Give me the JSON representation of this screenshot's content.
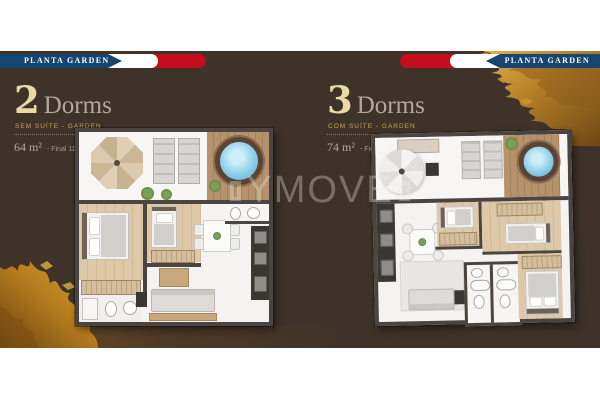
{
  "banners": {
    "left_label": "PLANTA GARDEN",
    "right_label": "PLANTA GARDEN"
  },
  "plans": [
    {
      "number": "2",
      "title": "Dorms",
      "subtitle": "SEM SUÍTE - GARDEN",
      "area": "64 m²",
      "final": "-  Final 11"
    },
    {
      "number": "3",
      "title": "Dorms",
      "subtitle": "COM SUÍTE - GARDEN",
      "area": "74 m²",
      "final": "-  Final 15"
    }
  ],
  "watermark": {
    "text": "YMOVE"
  },
  "colors": {
    "panel": "#3e3229",
    "banner_blue": "#16456f",
    "banner_red": "#c30d1e",
    "title_gold": "#ead9a2",
    "muted_gray": "#b3a89f",
    "subtitle_gold": "#c9a256",
    "wall": "#4a4541",
    "jacuzzi": "#86cbe7",
    "gold_texture": "#c08a2e"
  }
}
